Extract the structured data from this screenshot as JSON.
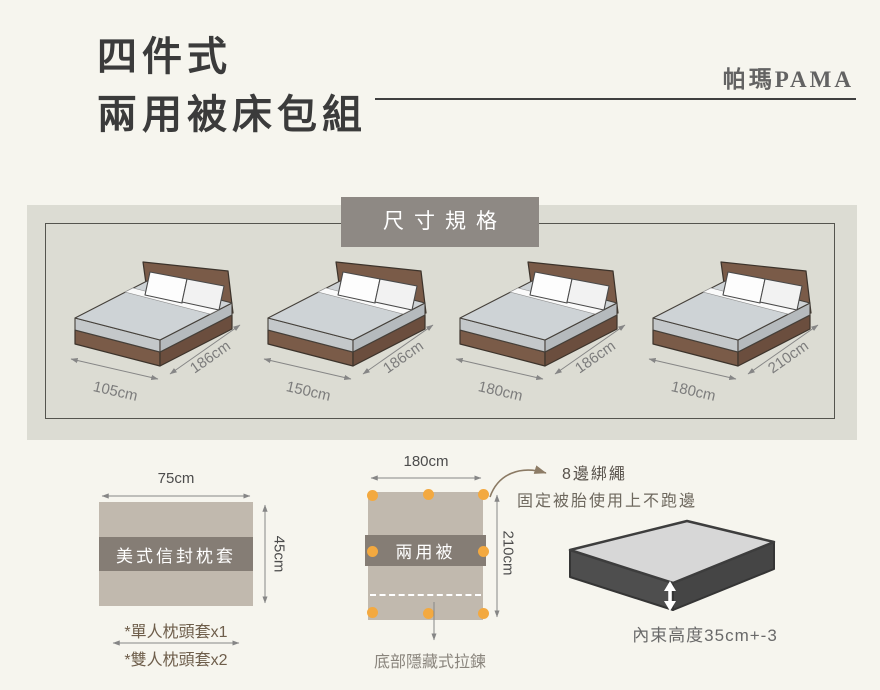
{
  "header": {
    "title_line1": "四件式",
    "title_line2": "兩用被床包組",
    "brand": "帕瑪PAMA"
  },
  "size_section": {
    "badge": "尺寸規格",
    "beds": [
      {
        "width_label": "105cm",
        "length_label": "186cm"
      },
      {
        "width_label": "150cm",
        "length_label": "186cm"
      },
      {
        "width_label": "180cm",
        "length_label": "186cm"
      },
      {
        "width_label": "180cm",
        "length_label": "210cm"
      }
    ]
  },
  "pillow": {
    "width_label": "75cm",
    "height_label": "45cm",
    "band_label": "美式信封枕套",
    "note_single": "*單人枕頭套x1",
    "note_double": "*雙人枕頭套x2"
  },
  "quilt": {
    "width_label": "180cm",
    "height_label": "210cm",
    "band_label": "兩用被",
    "tie_title": "8邊綁繩",
    "tie_desc": "固定被胎使用上不跑邊",
    "zipper_note": "底部隱藏式拉鍊"
  },
  "mattress": {
    "height_note": "內束高度35cm+-3"
  },
  "colors": {
    "background": "#f6f5ee",
    "panel_band": "#dcdcd3",
    "badge_gray": "#8e8984",
    "fabric_beige": "#c1b9ae",
    "fabric_band_gray": "#857d75",
    "accent_orange": "#f3a940",
    "bed_frame_brown": "#7a5b48",
    "note_brown": "#6e5e4b"
  }
}
